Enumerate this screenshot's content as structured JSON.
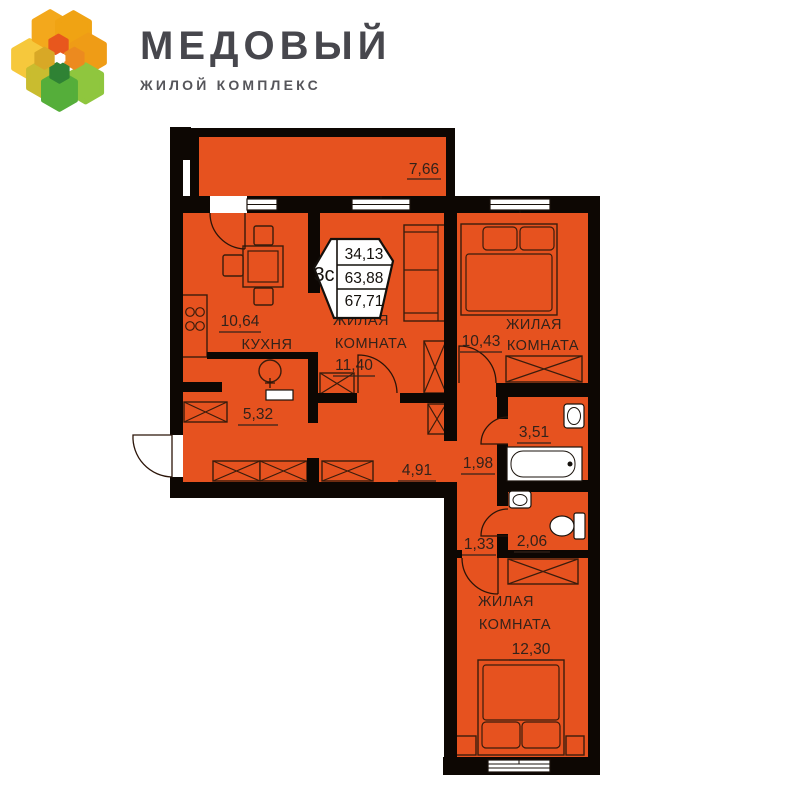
{
  "logo": {
    "title": "МЕДОВЫЙ",
    "subtitle": "ЖИЛОЙ КОМПЛЕКС"
  },
  "badge": {
    "rooms_label": "3с",
    "living_area": "34,13",
    "total_area": "63,88",
    "total_with_balcony": "67,71"
  },
  "rooms": {
    "balcony": {
      "area": "7,66"
    },
    "kitchen": {
      "name": "КУХНЯ",
      "area": "10,64"
    },
    "living_room": {
      "name_line1": "ЖИЛАЯ",
      "name_line2": "КОМНАТА",
      "area": "11,40"
    },
    "bedroom_top": {
      "name_line1": "ЖИЛАЯ",
      "name_line2": "КОМНАТА",
      "area": "10,43"
    },
    "bedroom_bottom": {
      "name_line1": "ЖИЛАЯ",
      "name_line2": "КОМНАТА",
      "area": "12,30"
    },
    "hallway": {
      "area": "5,32"
    },
    "corridor": {
      "area": "4,91"
    },
    "hall_small": {
      "area": "1,98"
    },
    "bathroom": {
      "area": "3,51"
    },
    "hall_tiny": {
      "area": "1,33"
    },
    "wc": {
      "area": "2,06"
    }
  },
  "colors": {
    "plan_fill": "#e6521f",
    "walls": "#0d0703",
    "label_text": "#33221a",
    "logo_title": "#47474d",
    "logo_subtitle": "#55555a"
  }
}
